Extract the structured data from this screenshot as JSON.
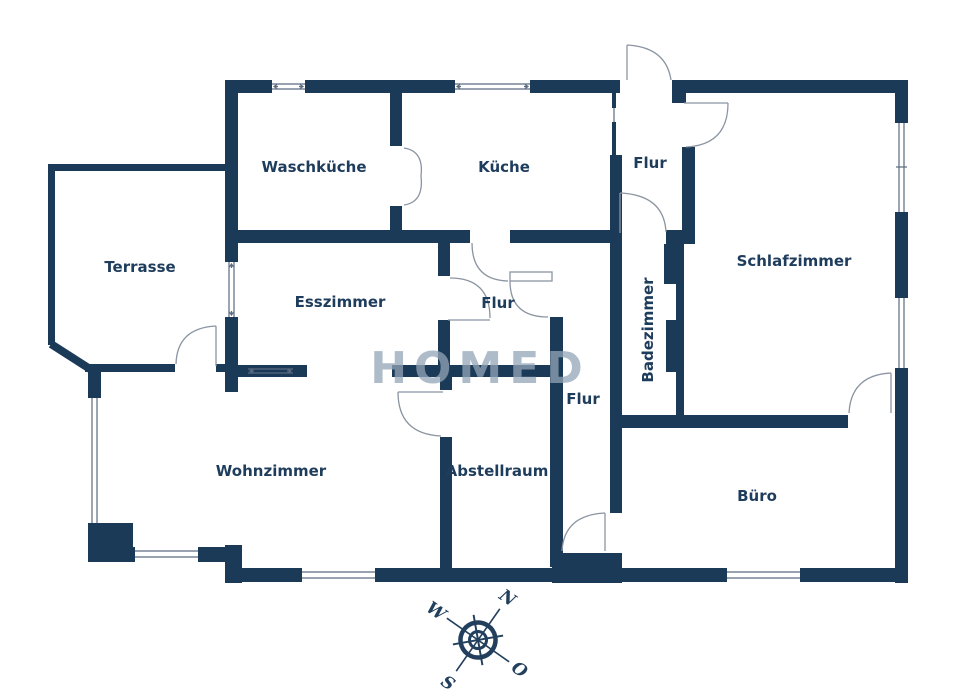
{
  "plan": {
    "title": "Grundriss",
    "rooms": {
      "waschkueche": {
        "label": "Waschküche"
      },
      "kueche": {
        "label": "Küche"
      },
      "flur_oben": {
        "label": "Flur"
      },
      "schlafzimmer": {
        "label": "Schlafzimmer"
      },
      "terrasse": {
        "label": "Terrasse"
      },
      "esszimmer": {
        "label": "Esszimmer"
      },
      "flur_mitte": {
        "label": "Flur"
      },
      "badezimmer": {
        "label": "Badezimmer"
      },
      "flur_unten": {
        "label": "Flur"
      },
      "wohnzimmer": {
        "label": "Wohnzimmer"
      },
      "abstellraum": {
        "label": "Abstellraum"
      },
      "buero": {
        "label": "Büro"
      }
    },
    "watermark": "HOMED"
  },
  "compass": {
    "north": "N",
    "east": "O",
    "south": "S",
    "west": "W"
  },
  "colors": {
    "wall": "#1b3a57",
    "label": "#1e3c5c",
    "door_arc": "#8b95a2",
    "window_line": "#5a6b80",
    "watermark": "#93a5b8",
    "compass": "#22405e"
  }
}
